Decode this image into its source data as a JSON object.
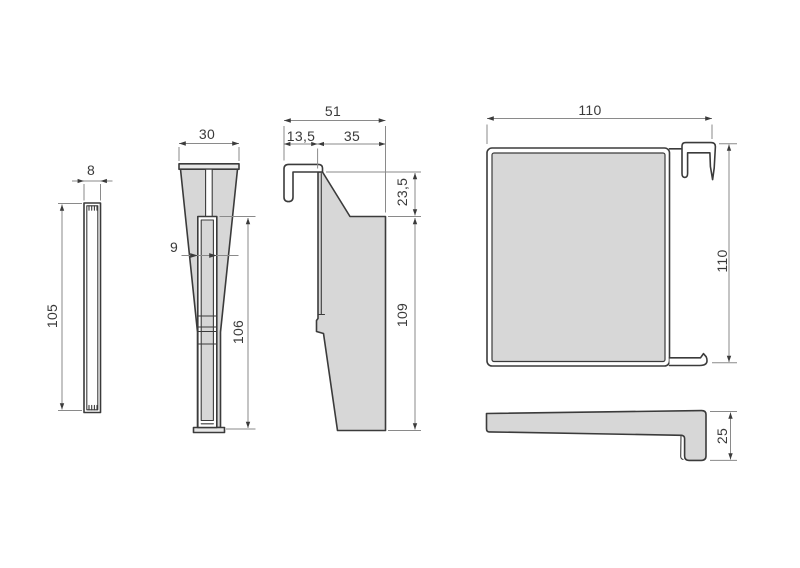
{
  "drawing": {
    "type": "technical dimension drawing",
    "colors": {
      "background": "#ffffff",
      "outline": "#3b3b3b",
      "part_fill": "#d7d7d7",
      "cap_fill": "#e7e7e7",
      "dim_line": "#8a8a8a",
      "text": "#3a3a3a"
    },
    "views": [
      {
        "name": "flat strip end view",
        "dimensions": [
          {
            "axis": "width",
            "value": "8"
          },
          {
            "axis": "height",
            "value": "105"
          }
        ]
      },
      {
        "name": "tapered leg front view",
        "dimensions": [
          {
            "axis": "top width",
            "value": "30"
          },
          {
            "axis": "inner width",
            "value": "9"
          },
          {
            "axis": "inner height",
            "value": "106"
          }
        ]
      },
      {
        "name": "hook bracket side view",
        "dimensions": [
          {
            "axis": "overall width",
            "value": "51"
          },
          {
            "axis": "hook width",
            "value": "13,5"
          },
          {
            "axis": "body width",
            "value": "35"
          },
          {
            "axis": "hook height",
            "value": "23,5"
          },
          {
            "axis": "body height",
            "value": "109"
          }
        ]
      },
      {
        "name": "back plate front view",
        "dimensions": [
          {
            "axis": "width",
            "value": "110"
          },
          {
            "axis": "height",
            "value": "110"
          }
        ]
      },
      {
        "name": "bracket profile bottom view",
        "dimensions": [
          {
            "axis": "leg height",
            "value": "25"
          }
        ]
      }
    ]
  }
}
